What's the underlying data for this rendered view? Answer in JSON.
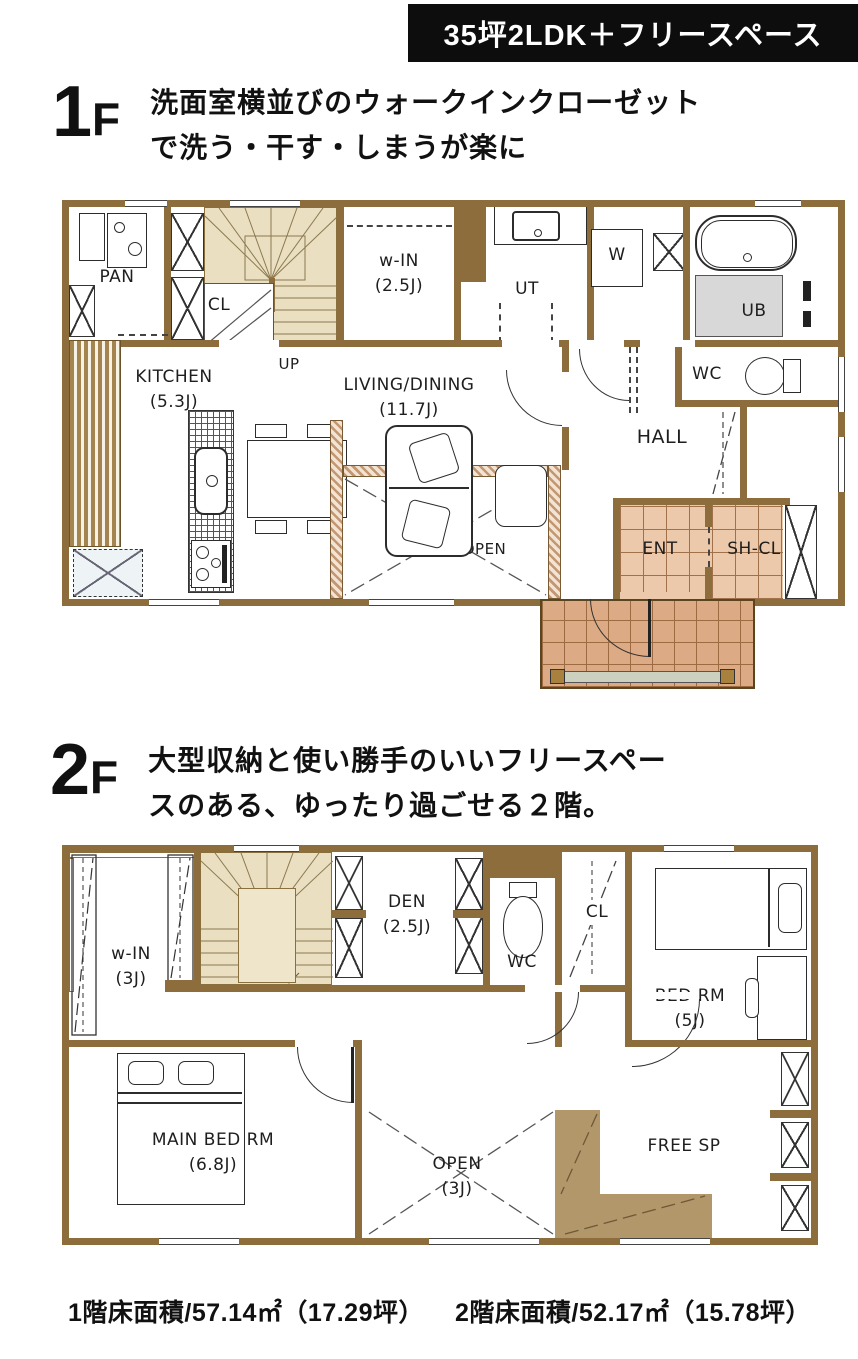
{
  "banner": {
    "title": "35坪2LDK＋フリースペース"
  },
  "floor1": {
    "num": "1",
    "f": "F",
    "desc1": "洗面室横並びのウォークインクローゼット",
    "desc2": "で洗う・干す・しまうが楽に",
    "rooms": {
      "pan": {
        "label": "PAN"
      },
      "cl": {
        "label": "CL"
      },
      "up": {
        "label": "UP"
      },
      "win": {
        "label": "w-IN",
        "size": "(2.5J)"
      },
      "ut": {
        "label": "UT"
      },
      "w": {
        "label": "W"
      },
      "ub": {
        "label": "UB"
      },
      "kitchen": {
        "label": "KITCHEN",
        "size": "(5.3J)"
      },
      "living": {
        "label": "LIVING/DINING",
        "size": "(11.7J)"
      },
      "hall": {
        "label": "HALL"
      },
      "wc": {
        "label": "WC"
      },
      "open": {
        "label": "OPEN"
      },
      "ent": {
        "label": "ENT"
      },
      "shcl": {
        "label": "SH-CL"
      }
    }
  },
  "floor2": {
    "num": "2",
    "f": "F",
    "desc1": "大型収納と使い勝手のいいフリースペー",
    "desc2": "スのある、ゆったり過ごせる２階。",
    "rooms": {
      "win": {
        "label": "w-IN",
        "size": "(3J)"
      },
      "den": {
        "label": "DEN",
        "size": "(2.5J)"
      },
      "wc": {
        "label": "WC"
      },
      "cl": {
        "label": "CL"
      },
      "bed": {
        "label": "BED RM",
        "size": "(5J)"
      },
      "main": {
        "label": "MAIN BED RM",
        "size": "(6.8J)"
      },
      "open": {
        "label": "OPEN",
        "size": "(3J)"
      },
      "free": {
        "label": "FREE SP"
      }
    }
  },
  "footer": {
    "area1": "1階床面積/57.14㎡（17.29坪）",
    "area2": "2階床面積/52.17㎡（15.78坪）"
  },
  "colors": {
    "wall": "#8e6d3c",
    "stairs": "#ebdfc2",
    "entry_tile": "#ecc9ab",
    "porch_tile": "#dcaa84",
    "free_counter": "#b2976b",
    "banner_bg": "#0d0d0d"
  }
}
